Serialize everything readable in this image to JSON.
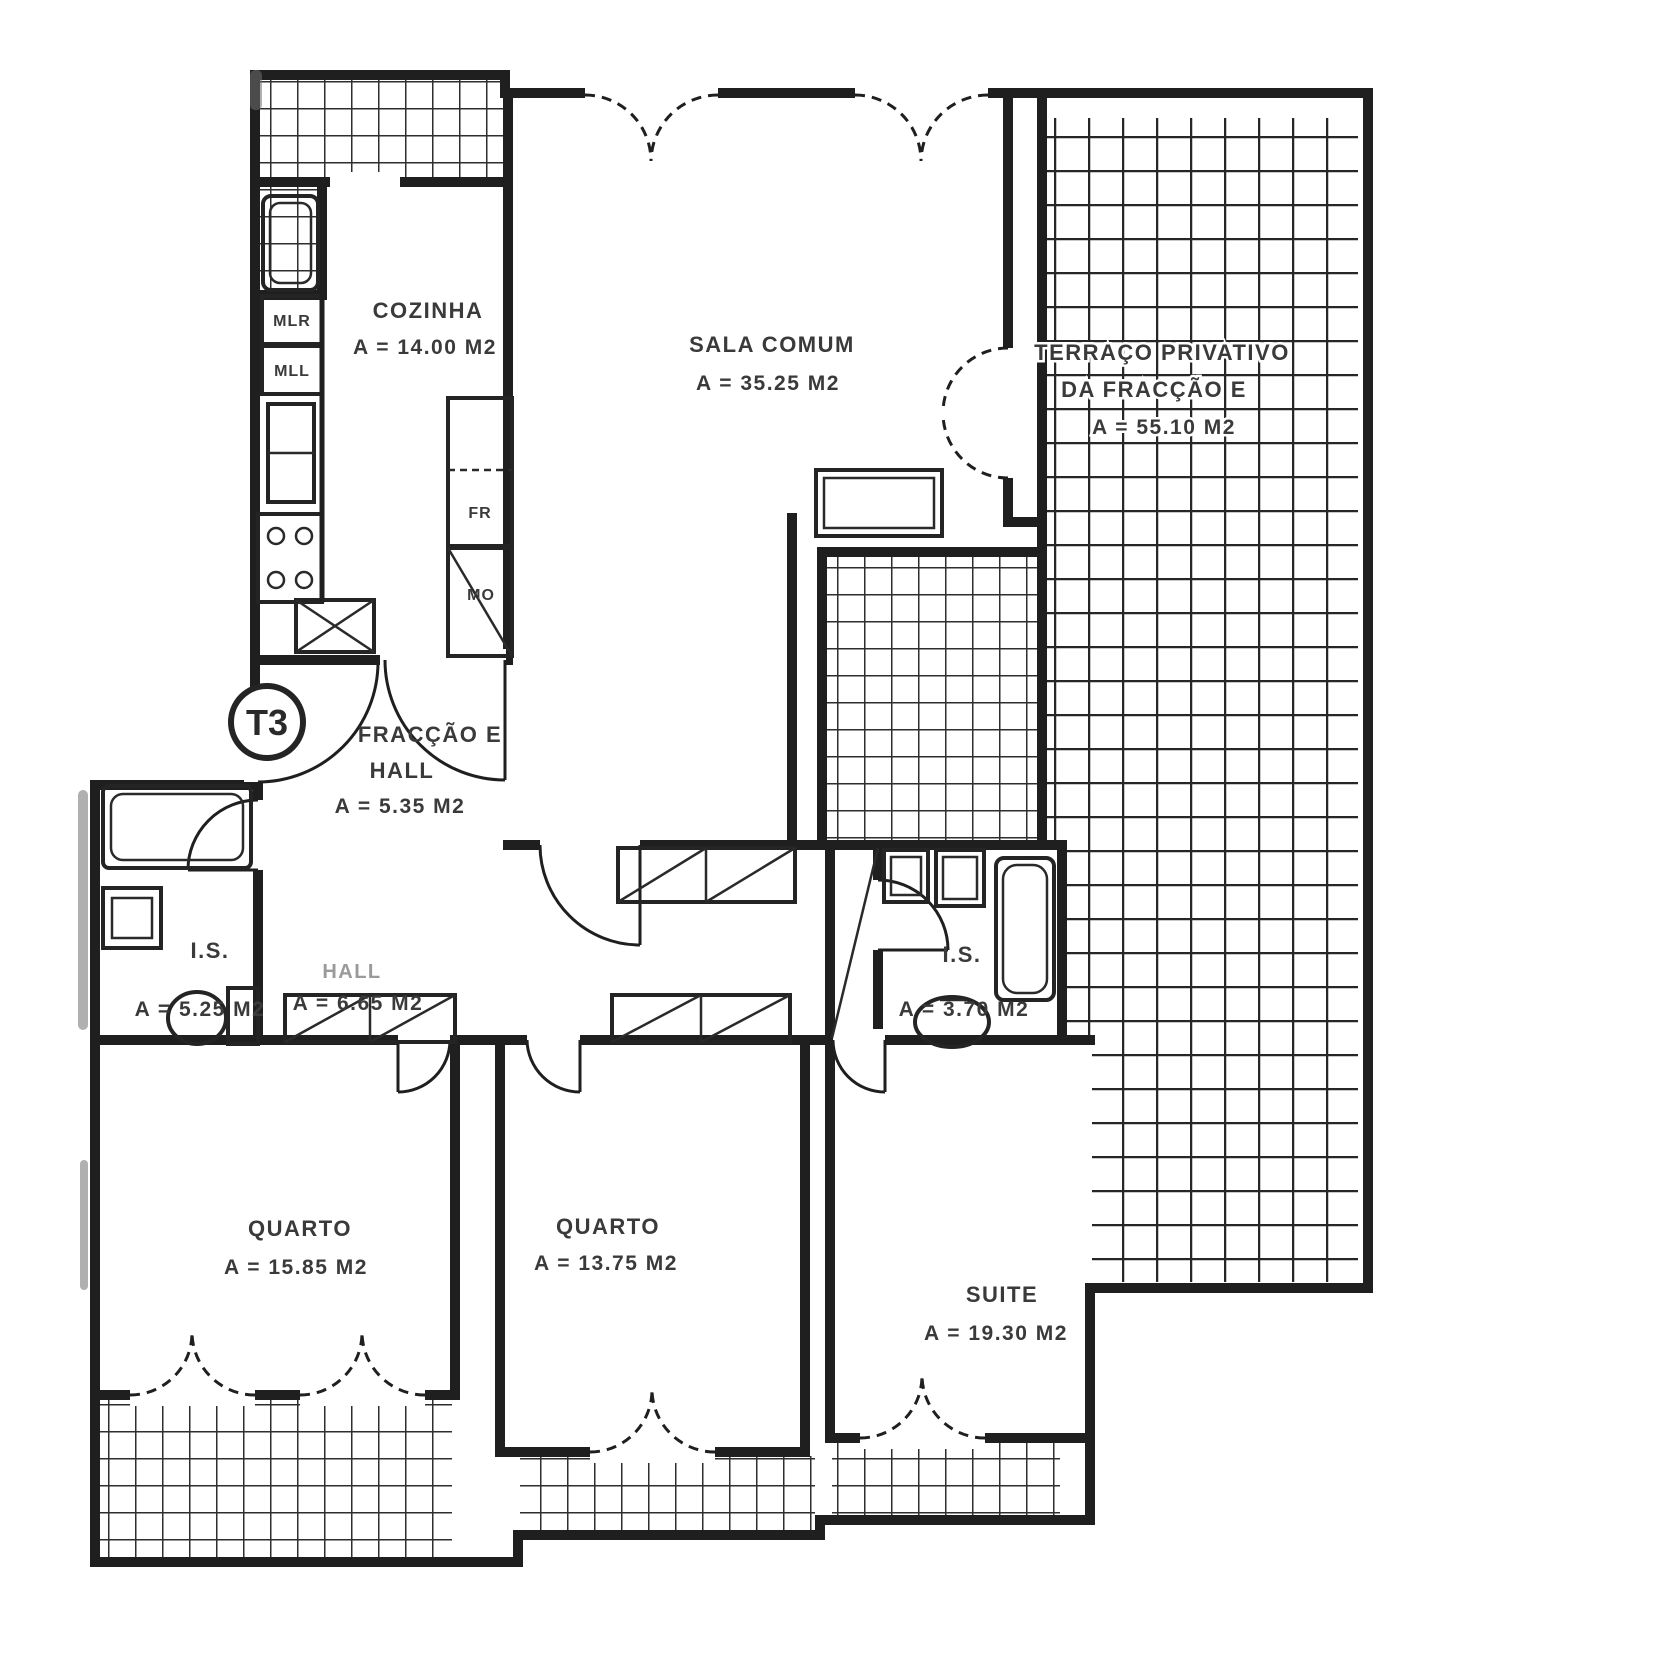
{
  "plan": {
    "badge": "T3",
    "rooms": {
      "cozinha": {
        "name": "COZINHA",
        "area": "A = 14.00 M2"
      },
      "sala": {
        "name": "SALA COMUM",
        "area": "A = 35.25 M2"
      },
      "terraco": {
        "line1": "TERRAÇO PRIVATIVO",
        "line2": "DA FRACÇÃO E",
        "area": "A = 55.10 M2"
      },
      "entry": {
        "line1": "FRACÇÃO E",
        "line2": "HALL",
        "area": "A = 5.35 M2"
      },
      "hall": {
        "name": "HALL",
        "area": "A = 6.65 M2"
      },
      "is_left": {
        "name": "I.S.",
        "area": "A = 5.25 M2"
      },
      "is_right": {
        "name": "I.S.",
        "area": "A = 3.70 M2"
      },
      "quarto1": {
        "name": "QUARTO",
        "area": "A = 15.85 M2"
      },
      "quarto2": {
        "name": "QUARTO",
        "area": "A = 13.75 M2"
      },
      "suite": {
        "name": "SUITE",
        "area": "A = 19.30 M2"
      }
    },
    "kitchen_labels": {
      "mlr": "MLR",
      "mll": "MLL",
      "fr": "FR",
      "mo": "MO"
    },
    "colors": {
      "ink": "#1f1f1f",
      "label_text": "#3a3a3a",
      "faint_text": "#9a9a9a",
      "background": "#ffffff"
    }
  }
}
